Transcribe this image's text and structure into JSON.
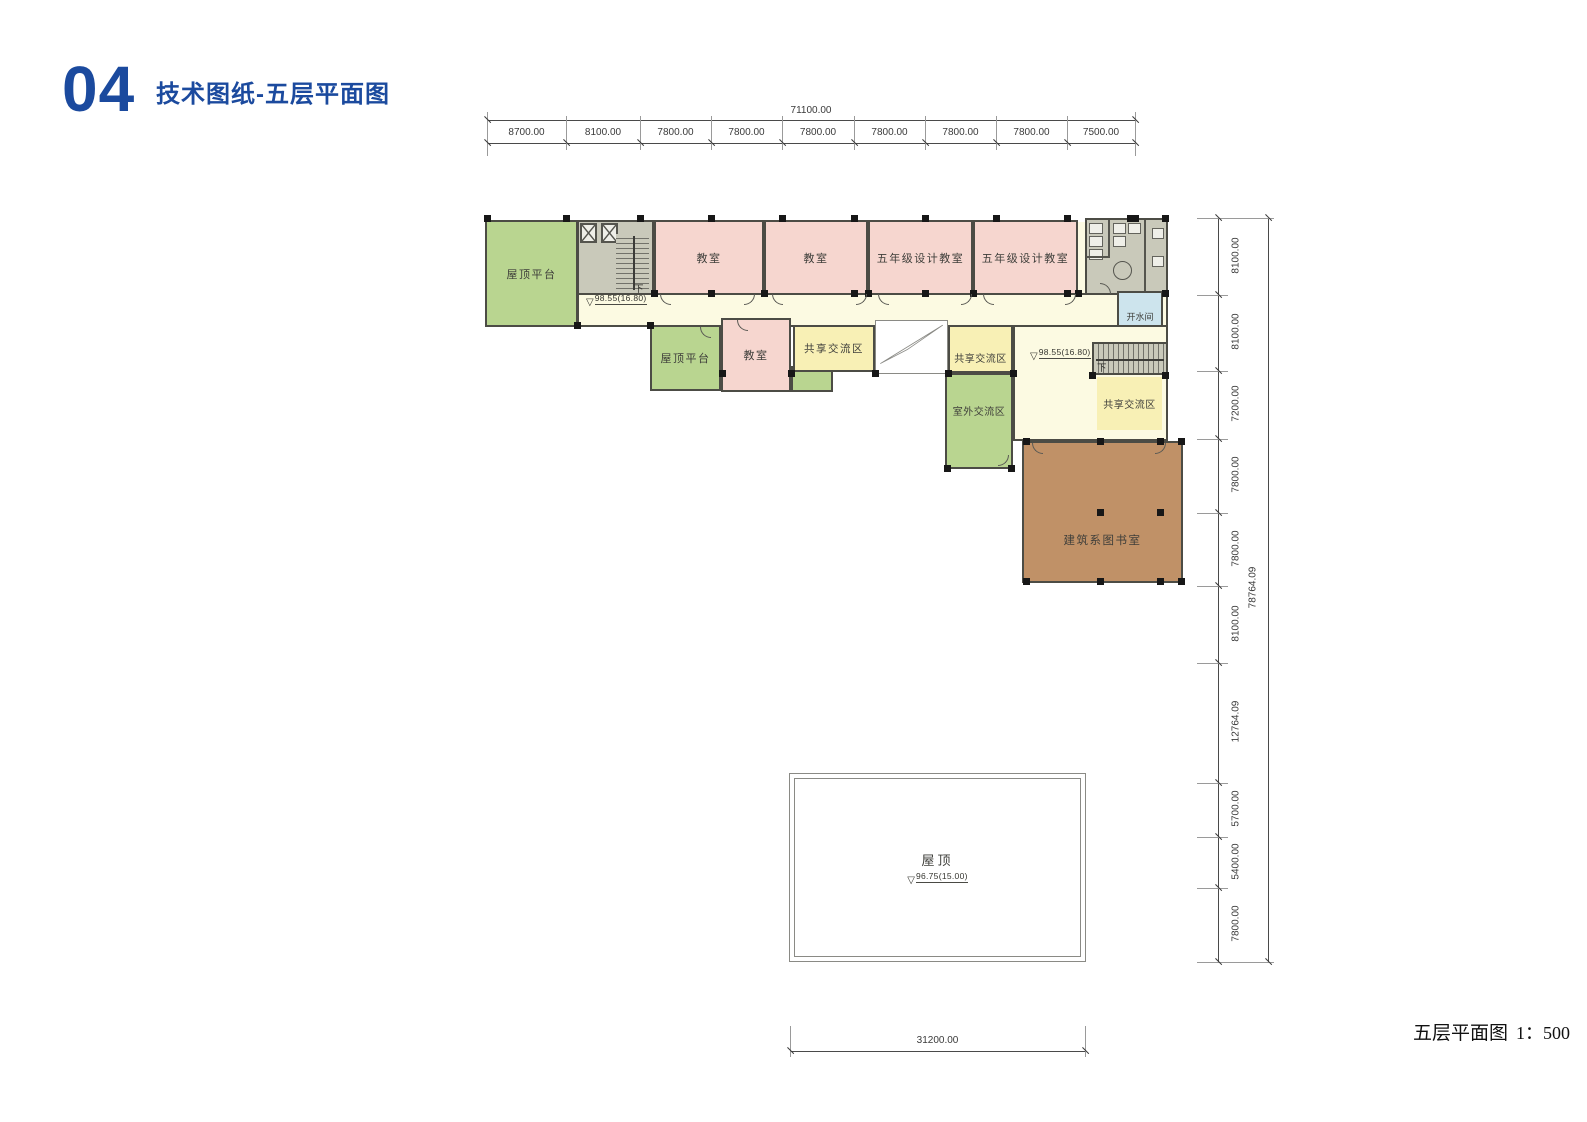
{
  "header": {
    "number": "04",
    "title": "技术图纸-五层平面图"
  },
  "caption": {
    "title": "五层平面图",
    "scale": "1：500"
  },
  "levels": {
    "main_floor": "98.55(16.80)",
    "roof": "96.75(15.00)",
    "down": "下"
  },
  "rooms": {
    "terrace1": "屋顶平台",
    "terrace2": "屋顶平台",
    "classroom1": "教室",
    "classroom2": "教室",
    "classroom3": "教室",
    "design1": "五年级设计教室",
    "design2": "五年级设计教室",
    "hot_water": "开水间",
    "shared1": "共享交流区",
    "shared2": "共享交流区",
    "shared3": "共享交流区",
    "outdoor": "室外交流区",
    "library": "建筑系图书室",
    "roof": "屋顶"
  },
  "dimensions": {
    "top": {
      "total": "71100.00",
      "segments": [
        "8700.00",
        "8100.00",
        "7800.00",
        "7800.00",
        "7800.00",
        "7800.00",
        "7800.00",
        "7800.00",
        "7500.00"
      ]
    },
    "right": {
      "total": "78764.09",
      "segments": [
        "8100.00",
        "8100.00",
        "7200.00",
        "7800.00",
        "7800.00",
        "8100.00",
        "12764.09",
        "5700.00",
        "5400.00",
        "7800.00"
      ]
    },
    "bottom": {
      "total": "31200.00"
    }
  },
  "colors": {
    "accent_blue": "#1b4a9e",
    "terrace_green": "#b9d590",
    "classroom_pink": "#f6d6cf",
    "corridor_yellow": "#fcfae2",
    "shared_yellow": "#f8f0b5",
    "core_gray": "#c9c9ba",
    "hot_water_blue": "#cde4ed",
    "library_brown": "#c09167",
    "wall": "#4c4c45"
  }
}
